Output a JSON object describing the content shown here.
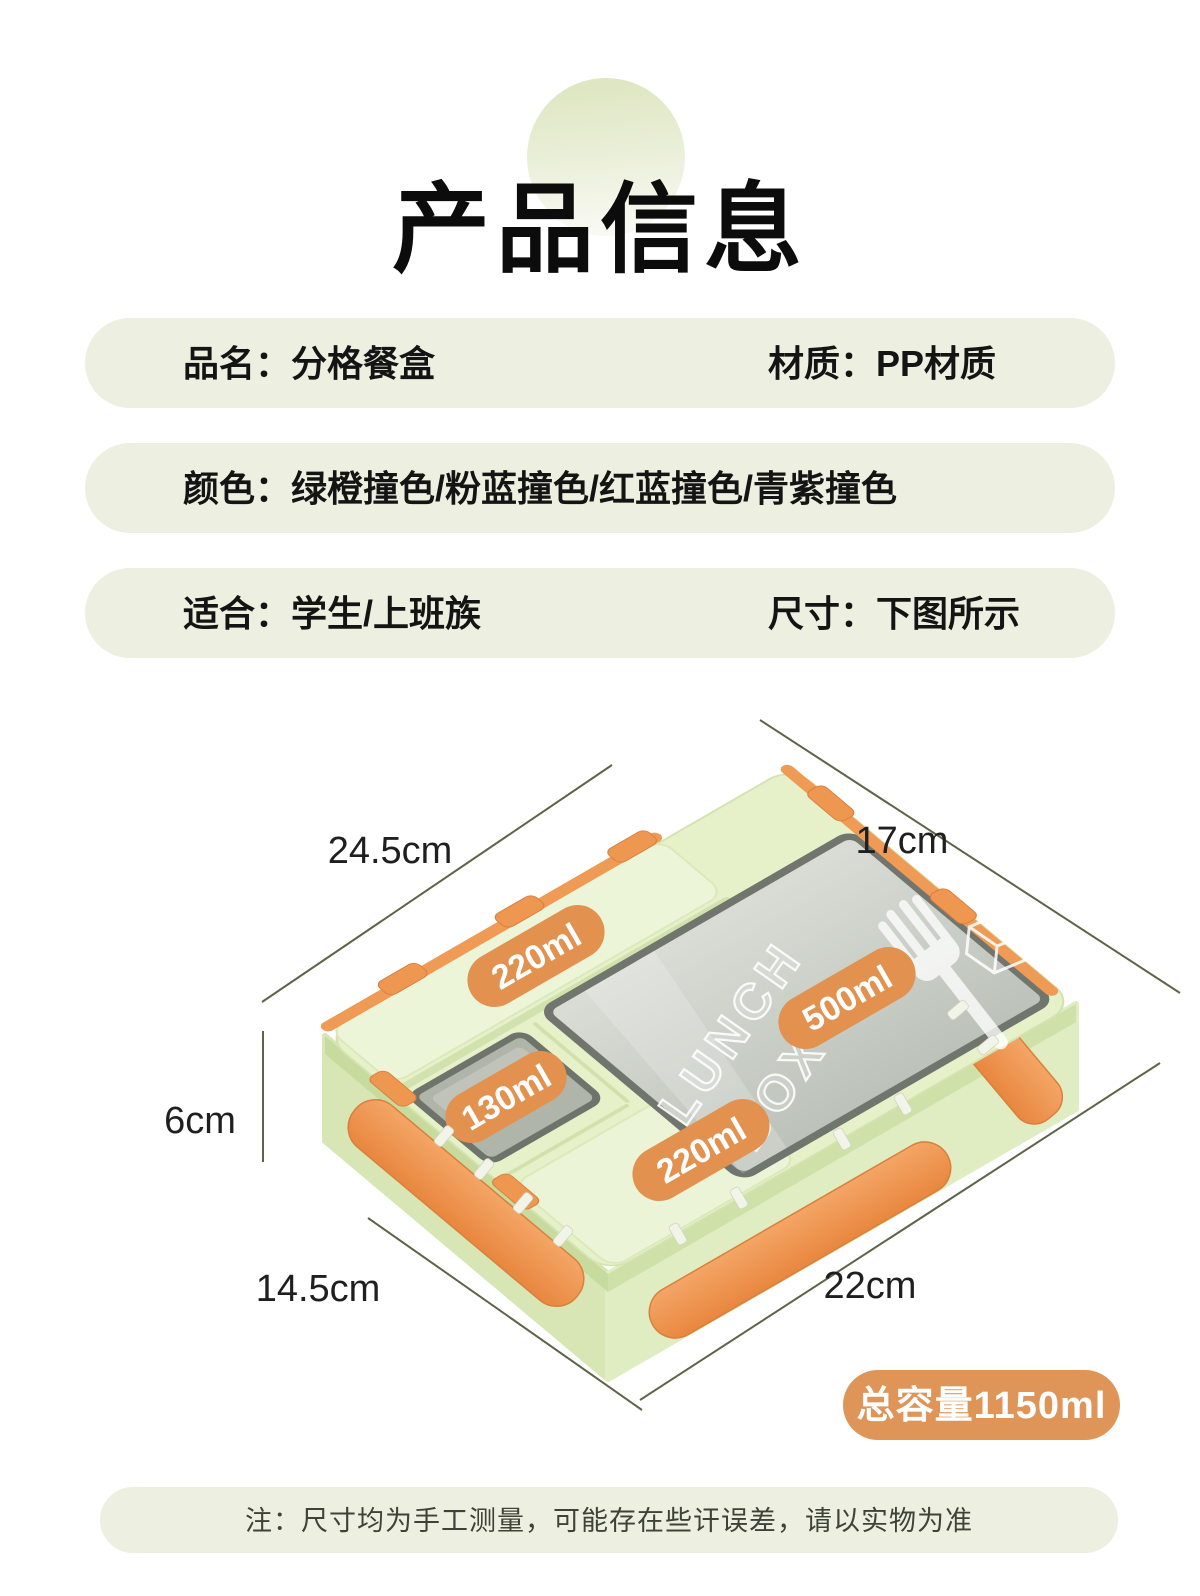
{
  "title": "产品信息",
  "info_bars": [
    {
      "left": "品名：分格餐盒",
      "right": "材质：PP材质"
    },
    {
      "left": "颜色：绿橙撞色/粉蓝撞色/红蓝撞色/青紫撞色",
      "right": ""
    },
    {
      "left": "适合：学生/上班族",
      "right": "尺寸：下图所示"
    }
  ],
  "diagram": {
    "dims": {
      "top_left": "24.5cm",
      "top_right": "17cm",
      "left": "6cm",
      "bottom_left": "14.5cm",
      "bottom_right": "22cm"
    },
    "compartments": {
      "cutlery": "220ml",
      "small": "130ml",
      "main": "500ml",
      "bottom": "220ml"
    },
    "lid_brand_line1": "LUNCH",
    "lid_brand_line2": "BOX+",
    "badge": "总容量1150ml"
  },
  "footer_note": "注：尺寸均为手工测量，可能存在些讦误差，请以实物为准",
  "colors": {
    "bar_background": "#edefe1",
    "box_green": "#e6f0c9",
    "latch_orange": "#ef9a55",
    "pill_orange": "#e2914f",
    "badge_orange": "#df9458",
    "dimension_line": "#5d6448",
    "text_dark": "#141414"
  }
}
